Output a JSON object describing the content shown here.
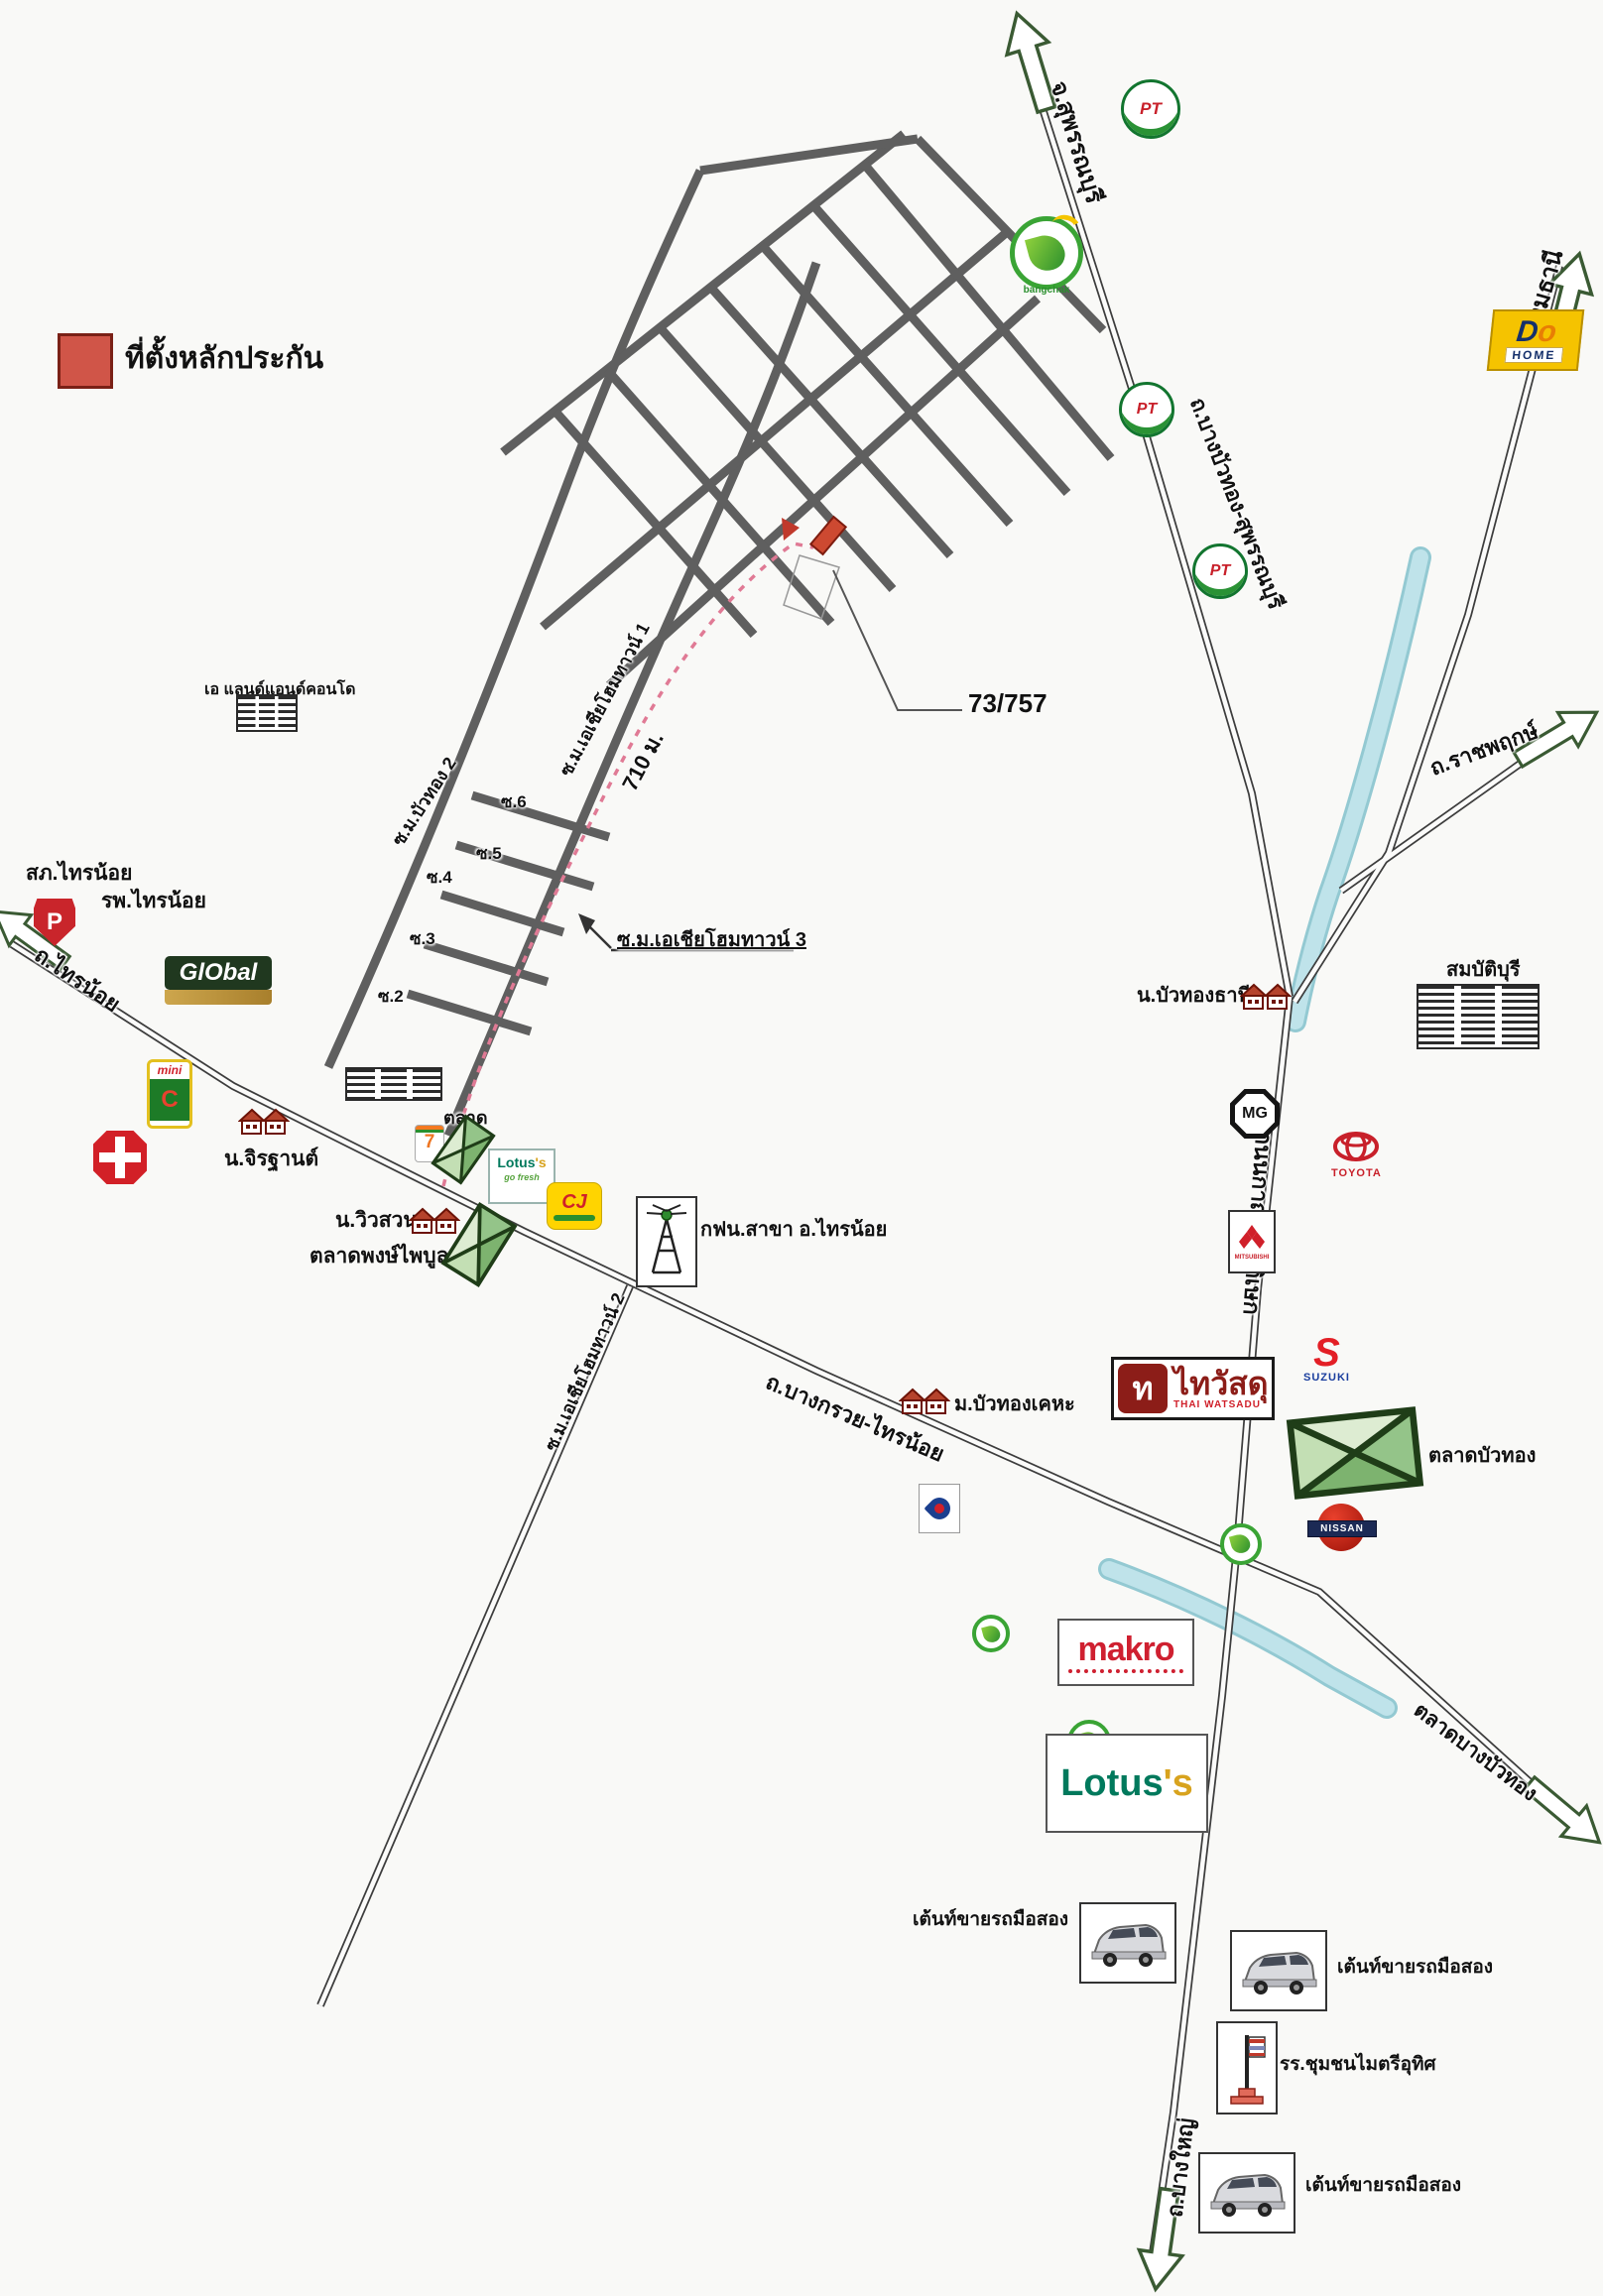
{
  "legend": {
    "title": "ที่ตั้งหลักประกัน"
  },
  "roads": {
    "suphanburi_dest": "จ.สุพรรณบุรี",
    "pathumthani_dest": "จ.ปทุมธานี",
    "bangbuathong_suphanburi": "ถ.บางบัวทอง-สุพรรณบุรี",
    "ratchaphruek": "ถ.ราชพฤกษ์",
    "kanchanaphisek": "ถนนกาญจนาภิเษก",
    "bangkruai_sainoi": "ถ.บางกรวย-ไทรน้อย",
    "sainoi": "ถ.ไทรน้อย",
    "bangyai": "ถ.บางใหญ่",
    "bangbuathong_market_dir": "ตลาดบางบัวทอง"
  },
  "sois": {
    "buathong2": "ซ.ม.บัวทอง 2",
    "asia_hometown1": "ซ.ม.เอเชียโฮมทาวน์ 1",
    "asia_hometown2": "ซ.ม.เอเชียโฮมทาวน์ 2",
    "asia_hometown3": "ซ.ม.เอเชียโฮมทาวน์ 3",
    "s2": "ซ.2",
    "s3": "ซ.3",
    "s4": "ซ.4",
    "s5": "ซ.5",
    "s6": "ซ.6",
    "distance": "710 ม."
  },
  "collateral": {
    "house_no": "73/757"
  },
  "places": {
    "police": "สภ.ไทรน้อย",
    "hospital": "รพ.ไทรน้อย",
    "jirathan_village": "น.จิรฐานต์",
    "land_condo": "เอ แลนด์แอนด์คอนโด",
    "market": "ตลาด",
    "viewsuan_village": "น.วิวสวน",
    "phongphaiboon_market": "ตลาดพงษ์ไพบูลย์",
    "mea_branch": "กฟน.สาขา อ.ไทรน้อย",
    "buathong_kheha": "ม.บัวทองเคหะ",
    "buathong_thani": "น.บัวทองธานี",
    "sombatburi": "สมบัติบุรี",
    "buathong_market": "ตลาดบัวทอง",
    "used_car_tent": "เต้นท์ขายรถมือสอง",
    "school": "รร.ชุมชนไมตรีอุทิศ"
  },
  "logos": {
    "pt": "PT",
    "bangchak": "bangchak",
    "dohome_d": "D",
    "dohome_o": "o",
    "dohome_home": "HOME",
    "police_p": "P",
    "global": "GlObal",
    "mini": "mini",
    "bigc_c": "C",
    "seven": "7",
    "lotus_prefix": "Lotus",
    "lotus_suffix": "'s",
    "gofresh": "go fresh",
    "cj": "CJ",
    "thaiwatsadu_mark": "ท",
    "thaiwatsadu": "ไทวัสดุ",
    "thaiwatsadu_en": "THAI WATSADU",
    "mg": "MG",
    "toyota": "TOYOTA",
    "nissan": "NISSAN",
    "suzuki_s": "S",
    "suzuki": "SUZUKI",
    "mitsubishi": "MITSUBISHI",
    "makro": "makro"
  },
  "colors": {
    "collateral": "#cd4931",
    "canal": "#bfe3ea",
    "road_minor": "#5f5f5f",
    "route_dash": "#e07a95"
  }
}
